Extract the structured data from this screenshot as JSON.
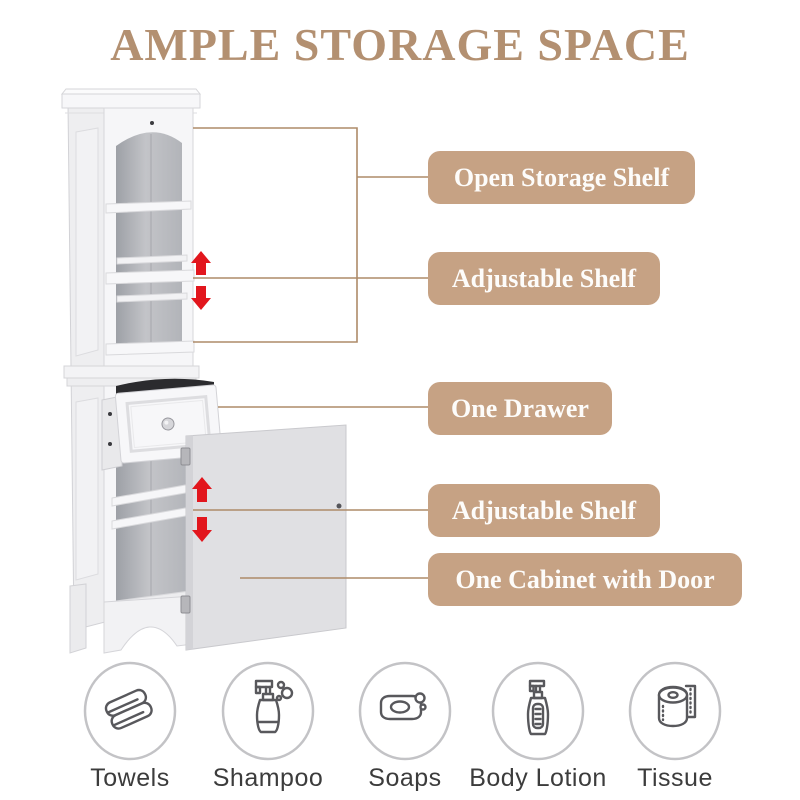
{
  "title": "AMPLE STORAGE SPACE",
  "colors": {
    "accent": "#b39071",
    "label_bg": "#c6a284",
    "label_text": "#fdfcfa",
    "line": "#ae8b69",
    "arrow": "#e2161d"
  },
  "callouts": [
    {
      "label": "Open Storage Shelf"
    },
    {
      "label": "Adjustable Shelf"
    },
    {
      "label": "One Drawer"
    },
    {
      "label": "Adjustable Shelf"
    },
    {
      "label": "One Cabinet with Door"
    }
  ],
  "features": [
    {
      "label": "Towels",
      "icon": "towels-icon"
    },
    {
      "label": "Shampoo",
      "icon": "shampoo-bottle-icon"
    },
    {
      "label": "Soaps",
      "icon": "soap-bar-icon"
    },
    {
      "label": "Body Lotion",
      "icon": "lotion-bottle-icon"
    },
    {
      "label": "Tissue",
      "icon": "tissue-roll-icon"
    }
  ]
}
